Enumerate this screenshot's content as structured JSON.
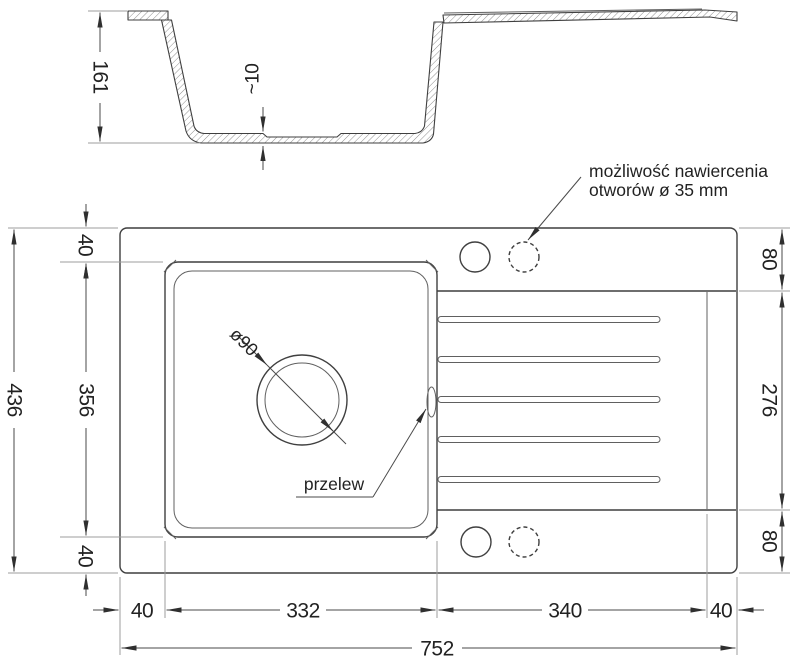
{
  "title": "sink-technical-drawing",
  "section": {
    "depth": "161",
    "floor_thickness": "~10"
  },
  "plan": {
    "left_total": "436",
    "left_top_offset": "40",
    "left_bowl": "356",
    "left_bottom_offset": "40",
    "right_top_offset": "80",
    "right_drainer": "276",
    "right_bottom_offset": "80",
    "bottom_left_offset": "40",
    "bottom_bowl": "332",
    "bottom_drainer": "340",
    "bottom_right_offset": "40",
    "bottom_total": "752",
    "drain_diameter": "ø90",
    "overflow_label": "przelew"
  },
  "note": {
    "line1": "możliwość nawiercenia",
    "line2": "otworów ø 35 mm"
  },
  "colors": {
    "line_dark": "#3f3f3f",
    "line_light": "#9c9c9c",
    "text": "#222222",
    "background": "#ffffff"
  }
}
